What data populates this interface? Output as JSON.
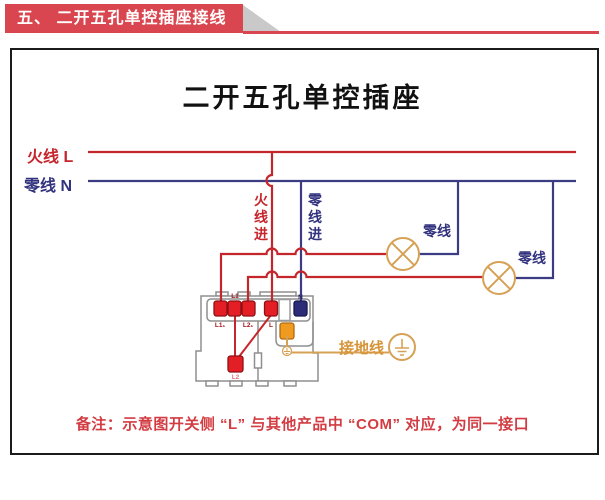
{
  "banner": {
    "title": "五、 二开五孔单控插座接线图"
  },
  "diagram": {
    "title": "二开五孔单控插座",
    "live_label": "火线 L",
    "neutral_label": "零线 N",
    "live_in_label": "火线进",
    "neutral_in_label": "零线进",
    "lamp1_neutral_label": "零线",
    "lamp2_neutral_label": "零线",
    "ground_label": "接地线",
    "terminals": {
      "t1": "L1₁",
      "t2": "L1",
      "t3": "L2₁",
      "t4": "L",
      "n": "N",
      "bottom": "L2"
    },
    "note": "备注：示意图开关侧 “L” 与其他产品中 “COM” 对应，为同一接口"
  },
  "colors": {
    "banner_red": "#d9464f",
    "live_wire_red": "#c5262c",
    "neutral_wire_blue": "#3c3c85",
    "lamp_orange": "#d7a155",
    "ground_orange": "#d7953a",
    "terminal_red": "#e41e25",
    "terminal_blue": "#2c2c78",
    "terminal_orange": "#f09a20",
    "note_red": "#d23c42"
  }
}
